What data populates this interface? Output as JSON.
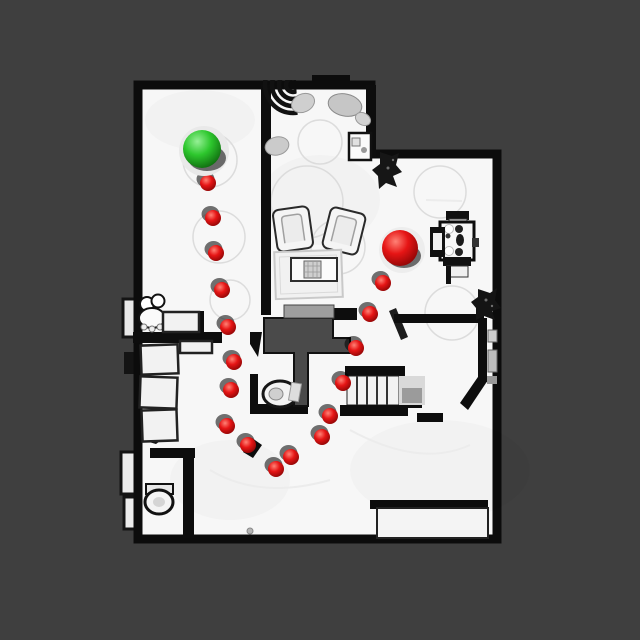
{
  "scene": {
    "description": "top-down-scanned-floorplan-with-navigation-path",
    "colors": {
      "background": "#3f3f3f",
      "floor": "#f7f7f7",
      "wall": "#0d0d0d",
      "stairwell": "#4a4a4a",
      "bench_gray": "#9e9e9e",
      "furniture_fill": "#f5f5f5",
      "furniture_stroke": "#232323",
      "rug_stroke": "#d7d7d7",
      "shadow": "rgba(0,0,0,0.55)",
      "start_green_hi": "#96f096",
      "start_green_mid": "#2dc72d",
      "start_green_dark": "#0b5e0b",
      "goal_red_hi": "#ff8276",
      "goal_red_mid": "#e61515",
      "goal_red_dark": "#7a0202"
    },
    "start_marker": {
      "label": "start-sphere",
      "x": 202,
      "y": 149,
      "radius": 19
    },
    "goal_marker": {
      "label": "goal-sphere",
      "x": 400,
      "y": 248,
      "radius": 18
    },
    "waypoint_radius": 8,
    "waypoints": [
      [
        208,
        183
      ],
      [
        213,
        218
      ],
      [
        216,
        253
      ],
      [
        222,
        290
      ],
      [
        228,
        327
      ],
      [
        234,
        362
      ],
      [
        231,
        390
      ],
      [
        227,
        426
      ],
      [
        248,
        445
      ],
      [
        276,
        469
      ],
      [
        291,
        457
      ],
      [
        322,
        437
      ],
      [
        330,
        416
      ],
      [
        343,
        383
      ],
      [
        356,
        348
      ],
      [
        370,
        314
      ],
      [
        383,
        283
      ]
    ],
    "objects": [
      "striped-floor-lamp",
      "pillows",
      "round-rug",
      "side-table",
      "armchair-left",
      "armchair-right",
      "coffee-table",
      "area-rug",
      "low-bench",
      "stairwell-opening",
      "dining-table",
      "dining-chairs",
      "potted-plant-top",
      "potted-plant-bottom",
      "staircase",
      "hall-toilet",
      "bathroom-toilet",
      "bathroom-sink",
      "wall-cabinets",
      "window-bench",
      "closet-shelves"
    ]
  }
}
